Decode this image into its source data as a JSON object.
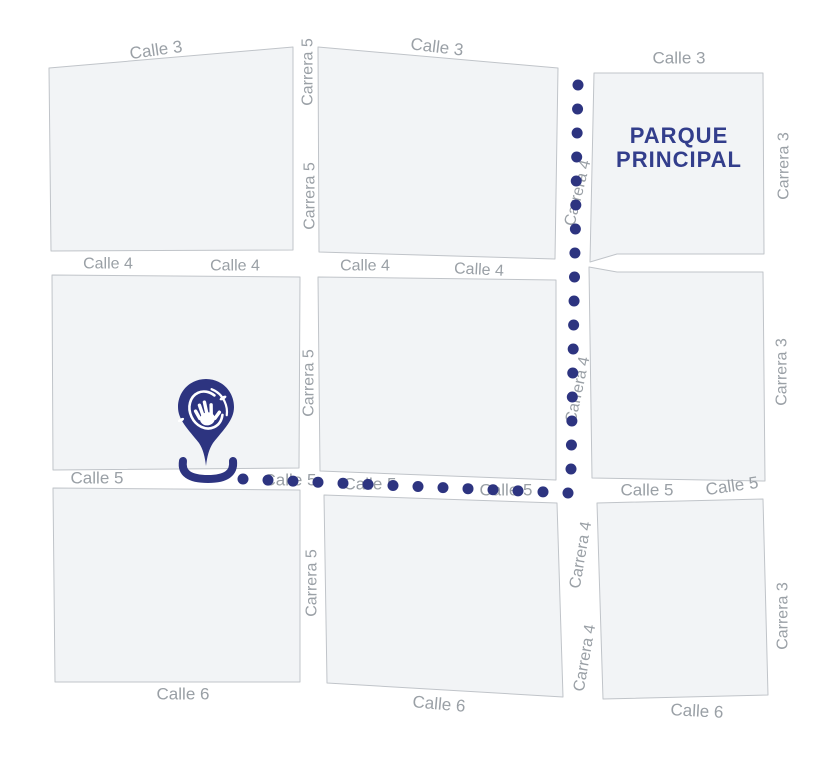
{
  "map": {
    "background": "#ffffff",
    "block_fill": "#f2f4f6",
    "block_stroke": "#c0c4c9",
    "label_color": "#9aa0a6",
    "route_color": "#2d3480",
    "pin_color": "#2d3480",
    "park_label": {
      "line1": "PARQUE",
      "line2": "PRINCIPAL",
      "color": "#333e8c"
    },
    "blocks": [
      {
        "name": "block-northwest",
        "points": "49,68 293,47 293,250 51,251"
      },
      {
        "name": "block-north",
        "points": "318,47 558,68 555,259 319,252"
      },
      {
        "name": "block-parque",
        "points": "594,73 763,73 764,254 617,254 590,262"
      },
      {
        "name": "block-west",
        "points": "52,275 300,277 299,468 53,470"
      },
      {
        "name": "block-center",
        "points": "318,277 556,280 556,480 320,471"
      },
      {
        "name": "block-east",
        "points": "589,267 617,272 763,272 765,481 592,478"
      },
      {
        "name": "block-southwest",
        "points": "53,488 300,490 300,682 55,682"
      },
      {
        "name": "block-south",
        "points": "324,495 557,503 563,697 327,683"
      },
      {
        "name": "block-southeast",
        "points": "597,503 763,499 768,695 603,699"
      }
    ],
    "street_labels": [
      {
        "text": "Calle 3",
        "x": 156,
        "y": 50,
        "rot": -8,
        "size": 17
      },
      {
        "text": "Calle 3",
        "x": 437,
        "y": 47,
        "rot": 7,
        "size": 17
      },
      {
        "text": "Calle 3",
        "x": 679,
        "y": 58,
        "rot": 0,
        "size": 17
      },
      {
        "text": "Carrera 5",
        "x": 308,
        "y": 72,
        "rot": -90,
        "size": 16
      },
      {
        "text": "Carrera 5",
        "x": 310,
        "y": 196,
        "rot": -90,
        "size": 16
      },
      {
        "text": "Carrera 4",
        "x": 578,
        "y": 193,
        "rot": -76,
        "size": 16
      },
      {
        "text": "Carrera 3",
        "x": 784,
        "y": 166,
        "rot": -90,
        "size": 16
      },
      {
        "text": "Calle 4",
        "x": 108,
        "y": 264,
        "rot": 0,
        "size": 16
      },
      {
        "text": "Calle 4",
        "x": 235,
        "y": 266,
        "rot": 0,
        "size": 16
      },
      {
        "text": "Calle 4",
        "x": 365,
        "y": 266,
        "rot": 0,
        "size": 16
      },
      {
        "text": "Calle 4",
        "x": 479,
        "y": 270,
        "rot": 3,
        "size": 16
      },
      {
        "text": "Carrera 5",
        "x": 309,
        "y": 383,
        "rot": -90,
        "size": 16
      },
      {
        "text": "Carrera 4",
        "x": 578,
        "y": 390,
        "rot": -78,
        "size": 16
      },
      {
        "text": "Carrera 3",
        "x": 782,
        "y": 372,
        "rot": -90,
        "size": 16
      },
      {
        "text": "Calle 5",
        "x": 97,
        "y": 478,
        "rot": 0,
        "size": 17
      },
      {
        "text": "Calle 5",
        "x": 290,
        "y": 480,
        "rot": 0,
        "size": 17
      },
      {
        "text": "Calle 5",
        "x": 370,
        "y": 484,
        "rot": 0,
        "size": 17
      },
      {
        "text": "Calle 5",
        "x": 506,
        "y": 490,
        "rot": 0,
        "size": 17
      },
      {
        "text": "Calle 5",
        "x": 647,
        "y": 490,
        "rot": 0,
        "size": 17
      },
      {
        "text": "Calle 5",
        "x": 732,
        "y": 486,
        "rot": -8,
        "size": 17
      },
      {
        "text": "Carrera 5",
        "x": 312,
        "y": 583,
        "rot": -90,
        "size": 16
      },
      {
        "text": "Carrera 4",
        "x": 581,
        "y": 555,
        "rot": -80,
        "size": 16
      },
      {
        "text": "Carrera 4",
        "x": 585,
        "y": 658,
        "rot": -80,
        "size": 16
      },
      {
        "text": "Carrera 3",
        "x": 783,
        "y": 616,
        "rot": -90,
        "size": 16
      },
      {
        "text": "Calle 6",
        "x": 183,
        "y": 694,
        "rot": 0,
        "size": 17
      },
      {
        "text": "Calle 6",
        "x": 439,
        "y": 704,
        "rot": 5,
        "size": 17
      },
      {
        "text": "Calle 6",
        "x": 697,
        "y": 711,
        "rot": 3,
        "size": 17
      }
    ],
    "route": {
      "dot_radius": 5.5,
      "vertical": {
        "x_top": 578,
        "x_bottom": 571,
        "y_start": 85,
        "y_step": 24,
        "count": 17
      },
      "horizontal": {
        "y_left": 479,
        "y_right": 493,
        "x_start": 243,
        "x_end": 568,
        "count": 14
      }
    },
    "pin": {
      "cx": 206,
      "cy": 407
    }
  }
}
